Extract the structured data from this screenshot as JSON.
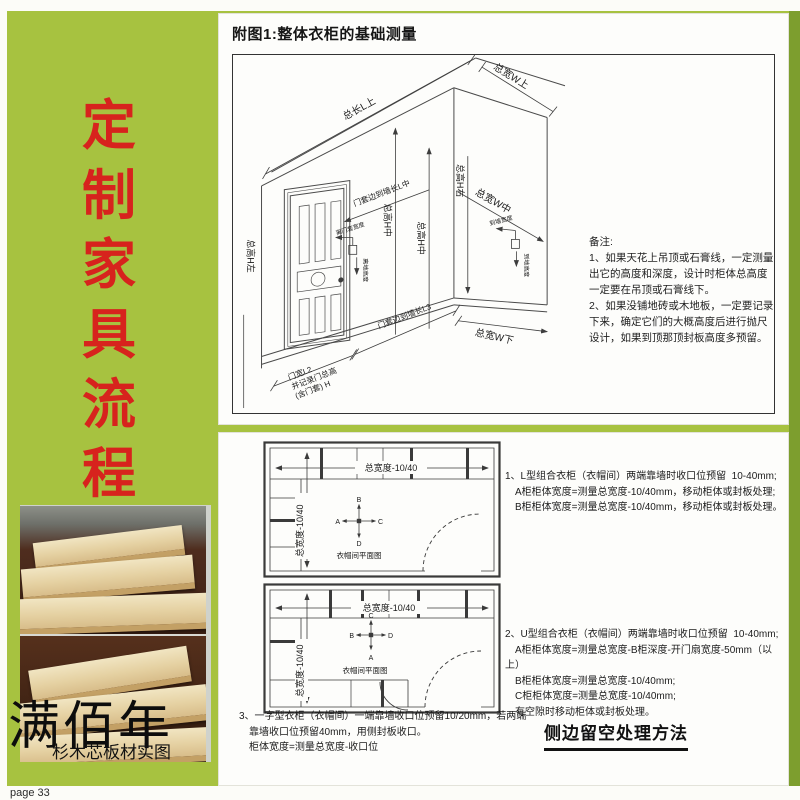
{
  "banner": {
    "chars": [
      "定",
      "制",
      "家",
      "具",
      "流",
      "程"
    ]
  },
  "brand": {
    "name": "满佰年",
    "caption": "杉木芯板材实图"
  },
  "page_label": "page 33",
  "colors": {
    "background_green": "#a7c240",
    "accent_red": "#d7231d"
  },
  "top_panel": {
    "title": "附图1:整体衣柜的基础测量",
    "dims": {
      "total_length_top": "总长L上",
      "total_width_top": "总宽W上",
      "total_width_mid": "总宽W中",
      "total_width_bottom": "总宽W下",
      "total_height_left": "总高H左",
      "total_height_mid": "总高H中",
      "total_height_mid2": "总高H中",
      "total_height_right": "总高H右",
      "door_to_wall_mid": "门套边到墙长L中",
      "door_to_wall_l3": "门套边到墙长L3",
      "door_width_l2": "门宽L2",
      "door_width_l2b": "并记录门总高",
      "door_width_l2c": "(含门套) H",
      "switch_width": "离门套宽度",
      "switch_height": "离地高度",
      "socket_width": "到墙宽度",
      "socket_height": "到地高度"
    },
    "notes": [
      "备注:",
      "1、如果天花上吊顶或石膏线，一定测量",
      "出它的高度和深度，设计时柜体总高度",
      "一定要在吊顶或石膏线下。",
      "2、如果没铺地砖或木地板，一定要记录",
      "下来，确定它们的大概高度后进行抛尺",
      "设计，如果到顶那顶封板高度多预留。"
    ]
  },
  "bottom_panel": {
    "plan1": {
      "h_dim": "总宽度-10/40",
      "v_dim": "总宽度-10/40",
      "caption": "衣帽间平面图",
      "compass": {
        "top": "B",
        "left": "A",
        "right": "C",
        "bottom": "D"
      }
    },
    "plan2": {
      "h_dim": "总宽度-10/40",
      "v_dim": "总宽度-10/40",
      "caption": "衣帽间平面图",
      "compass": {
        "top": "C",
        "left": "B",
        "right": "D",
        "bottom": "A"
      }
    },
    "note1": [
      "1、L型组合衣柜（衣帽间）两端靠墙时收口位预留  10-40mm;",
      "　A柜柜体宽度=测量总宽度-10/40mm，移动柜体或封板处理;",
      "　B柜柜体宽度=测量总宽度-10/40mm，移动柜体或封板处理。"
    ],
    "note2": [
      "2、U型组合衣柜（衣帽间）两端靠墙时收口位预留  10-40mm;",
      "　A柜柜体宽度=测量总宽度-B柜深度-开门扇宽度-50mm（以上）",
      "　B柜柜体宽度=测量总宽度-10/40mm;",
      "　C柜柜体宽度=测量总宽度-10/40mm;",
      "　有空隙时移动柜体或封板处理。"
    ],
    "note3": [
      "3、一字型衣柜（衣帽间）一端靠墙收口位预留10/20mm，若两端",
      "　靠墙收口位预留40mm，用侧封板收口。",
      "　柜体宽度=测量总宽度-收口位"
    ],
    "section_title": "侧边留空处理方法"
  }
}
